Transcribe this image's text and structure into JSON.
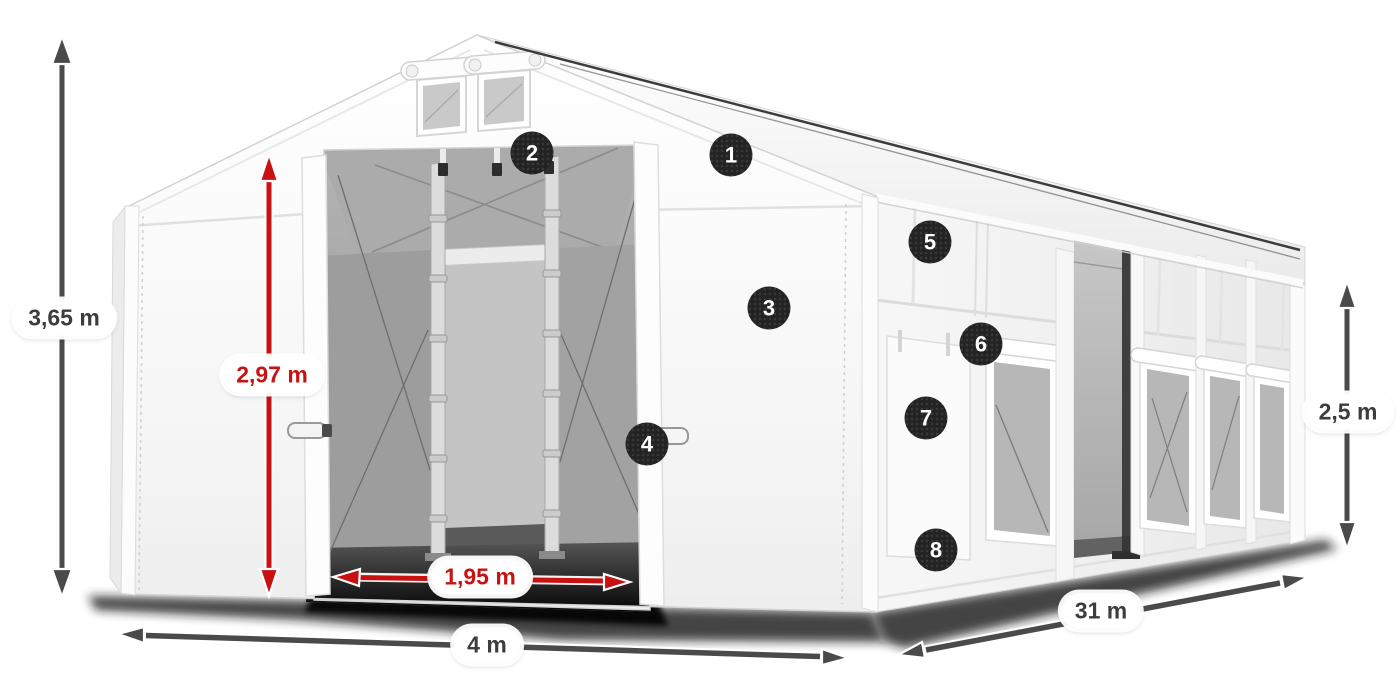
{
  "page": {
    "title": "Tent dimensions diagram",
    "background": "#ffffff"
  },
  "colors": {
    "dimension_gray": "#4a4a4a",
    "dimension_red": "#c81212",
    "label_text_gray": "#3d3d3d",
    "label_background": "#ffffff",
    "badge_background": "#232323",
    "badge_text": "#ffffff"
  },
  "dimensions": {
    "total_height": {
      "label": "3,65 m",
      "style": "gray"
    },
    "door_height": {
      "label": "2,97 m",
      "style": "red"
    },
    "door_width": {
      "label": "1,95 m",
      "style": "red"
    },
    "front_width": {
      "label": "4 m",
      "style": "gray"
    },
    "length": {
      "label": "31 m",
      "style": "gray"
    },
    "side_height": {
      "label": "2,5 m",
      "style": "gray"
    }
  },
  "callouts": {
    "c1": "1",
    "c2": "2",
    "c3": "3",
    "c4": "4",
    "c5": "5",
    "c6": "6",
    "c7": "7",
    "c8": "8"
  }
}
